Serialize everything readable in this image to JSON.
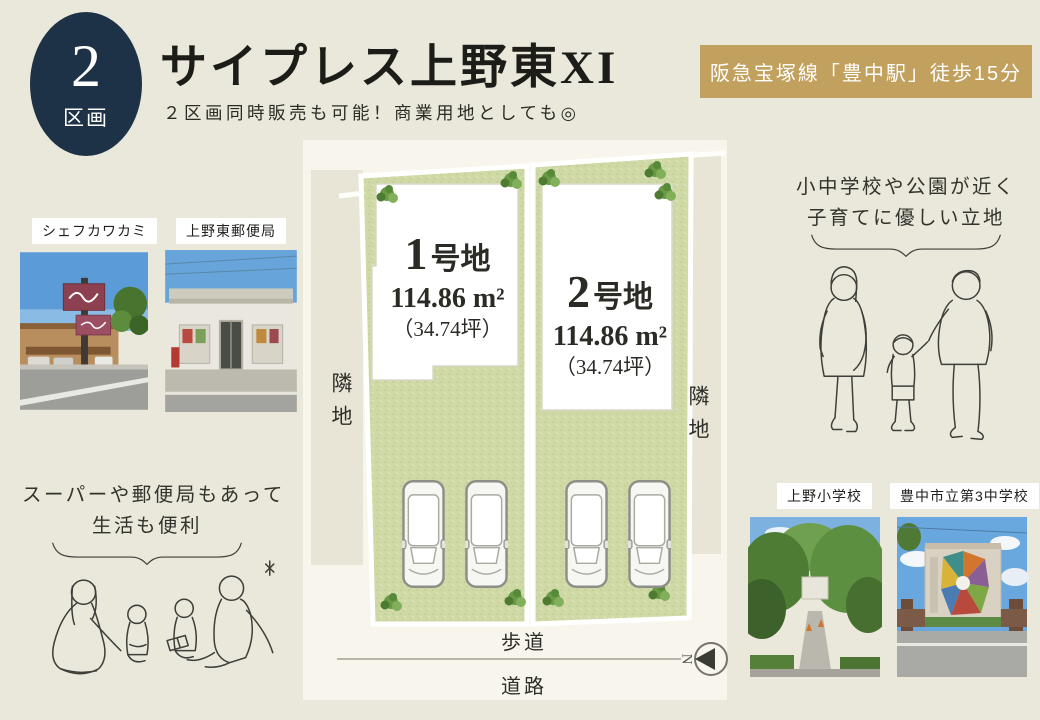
{
  "badge": {
    "number": "2",
    "label": "区画"
  },
  "header": {
    "title": "サイプレス上野東XI",
    "subtitle": "２区画同時販売も可能！商業用地としても◎"
  },
  "station_banner": {
    "text": "阪急宝塚線「豊中駅」徒歩15分"
  },
  "nearby": {
    "photos": [
      {
        "label": "シェフカワカミ"
      },
      {
        "label": "上野東郵便局"
      }
    ],
    "message_line1": "スーパーや郵便局もあって",
    "message_line2": "生活も便利"
  },
  "schools": {
    "photos": [
      {
        "label": "上野小学校"
      },
      {
        "label": "豊中市立第3中学校"
      }
    ],
    "message_line1": "小中学校や公園が近く",
    "message_line2": "子育てに優しい立地"
  },
  "site_plan": {
    "lots": [
      {
        "num": "1",
        "suffix": "号地",
        "area": "114.86 m²",
        "tsubo": "（34.74坪）"
      },
      {
        "num": "2",
        "suffix": "号地",
        "area": "114.86 m²",
        "tsubo": "（34.74坪）"
      }
    ],
    "adjacent_left": "隣地",
    "adjacent_right": "隣地",
    "sidewalk": "歩道",
    "road": "道路",
    "compass_letter": "N"
  },
  "colors": {
    "page_bg": "#eae8db",
    "badge_navy": "#1e3247",
    "banner_gold": "#c2a05d",
    "plan_green": "#cfd9a6",
    "panel_bg": "#f7f5ec",
    "strip_beige": "#e9e5d6"
  }
}
